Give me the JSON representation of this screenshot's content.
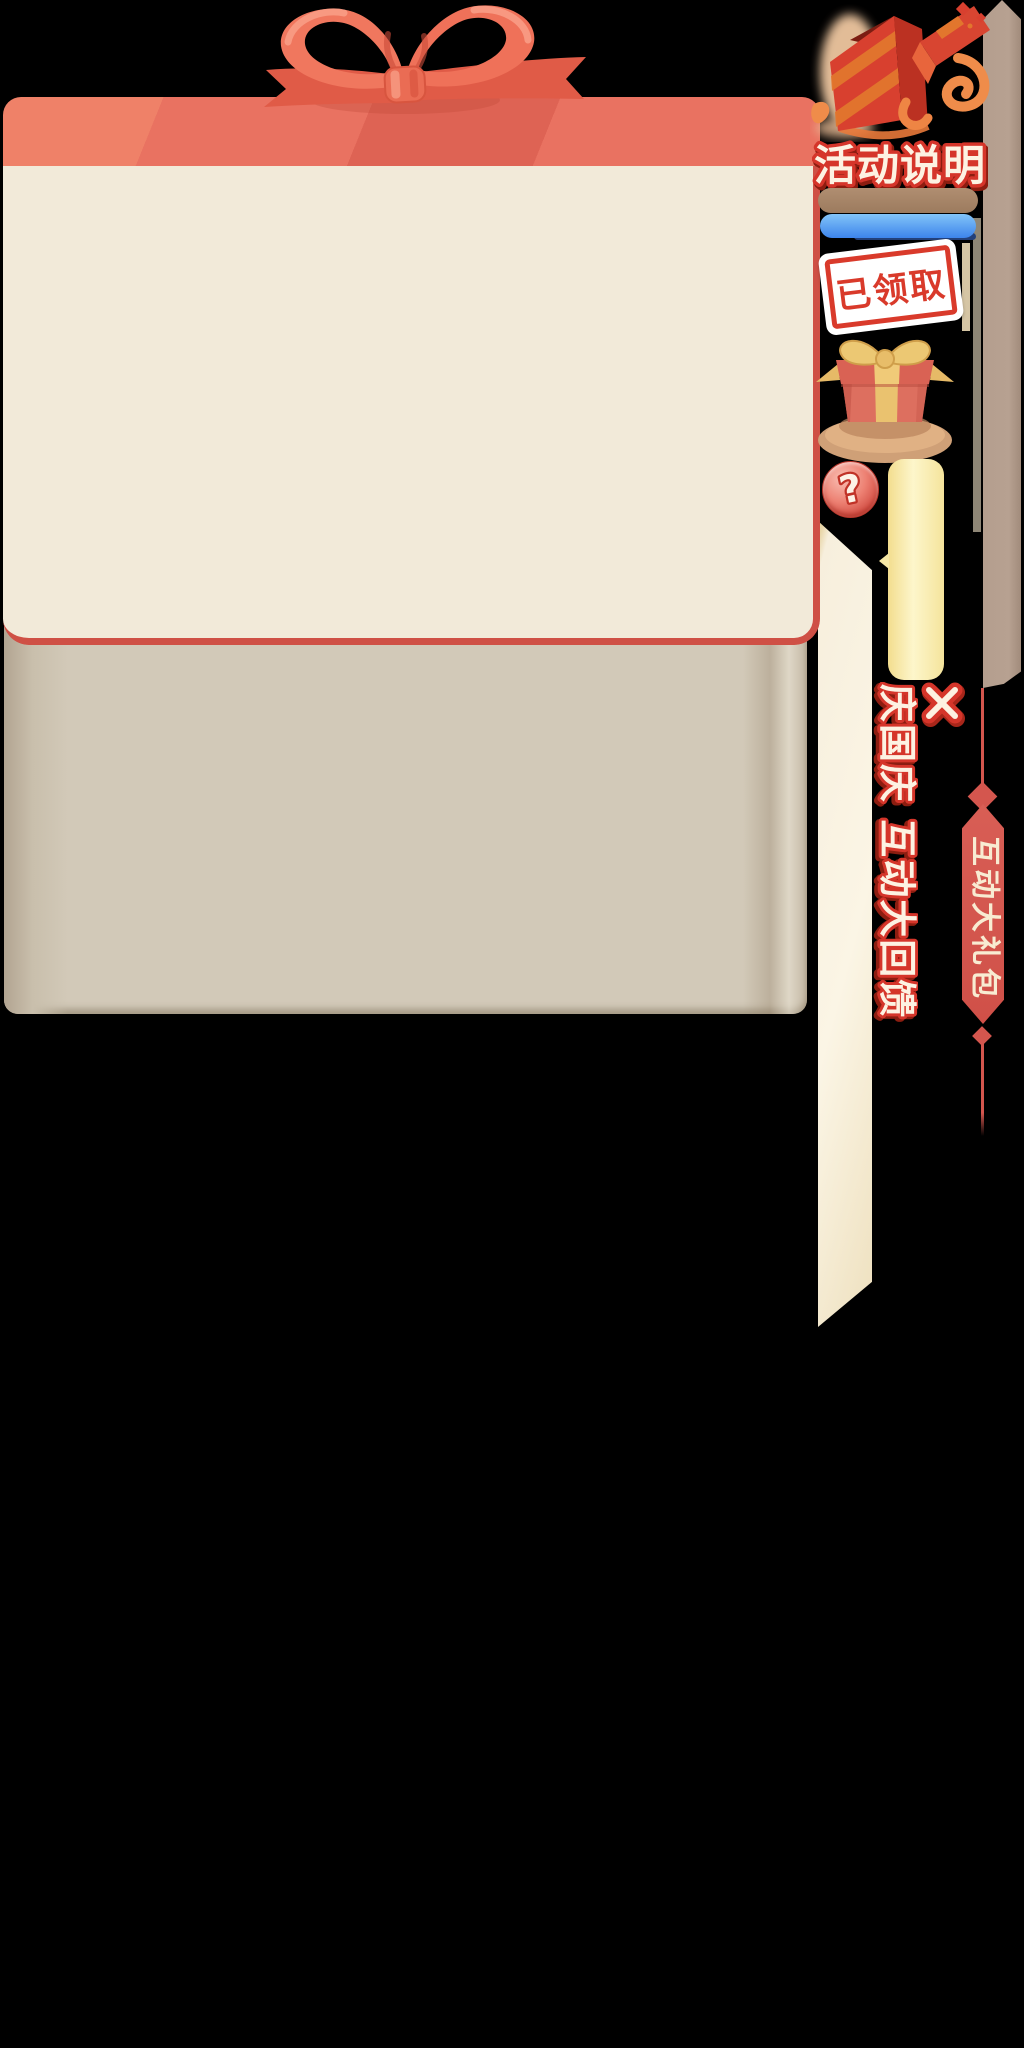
{
  "colors": {
    "background": "#000000",
    "panel_header": "#e97261",
    "panel_body": "#f2ead9",
    "panel_border": "#cf5045",
    "tan_panel": "#d2c9b8",
    "side_strip": "#b39d8d",
    "scroll_edge": "#f7efdb",
    "banner_red": "#d4564e",
    "accent_red": "#d5352a",
    "accent_cream": "#fdf2e2",
    "bar_brown": "#a5846a",
    "bar_blue": "#4a8ff0",
    "tooltip_yellow": "#fbf1b9",
    "stamp_red": "#d93a2b"
  },
  "right_rail": {
    "section_title": "活动说明",
    "stamp_label": "已领取",
    "help_label": "?",
    "icons": {
      "open_gift_icon": "opened red gift box with orange ribbon",
      "gift_box_icon": "red gift box with gold bow on plate",
      "question_icon": "?",
      "close_icon": "✕"
    }
  },
  "overlay": {
    "slogan": "庆国庆 互动大回馈",
    "side_banner": "互动大礼包"
  }
}
